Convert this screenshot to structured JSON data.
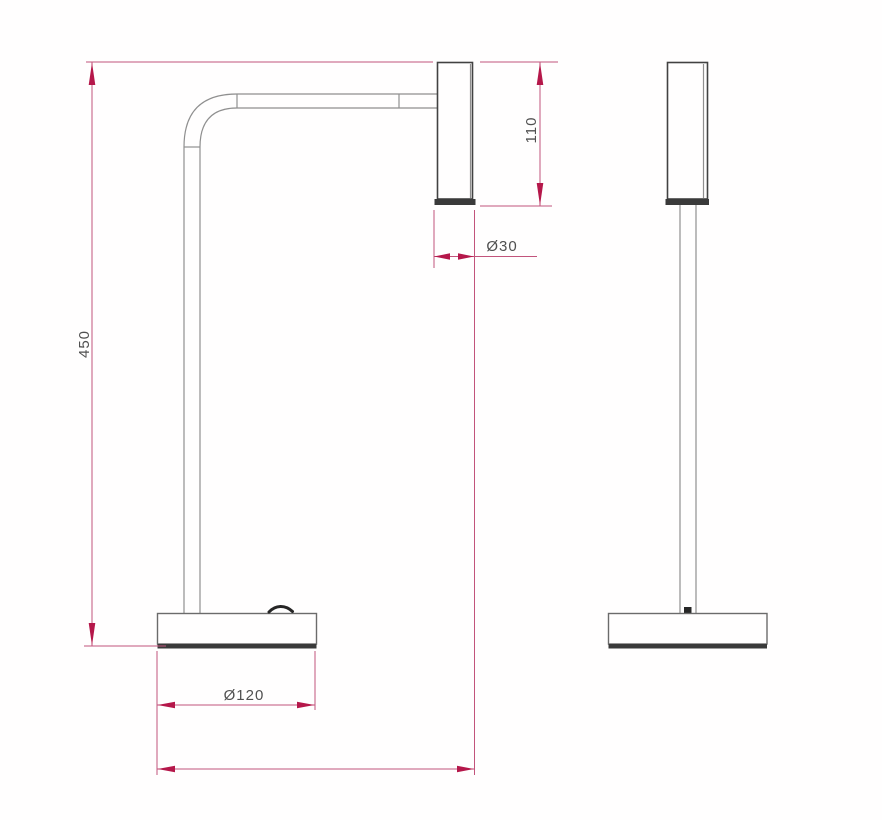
{
  "drawing": {
    "kind": "technical-dimension-drawing",
    "subject": "desk lamp, front and side orthographic views"
  },
  "dimensions": {
    "overall_height": "450",
    "head_height": "110",
    "head_diameter": "Ø30",
    "base_diameter": "Ø120",
    "overall_depth": "241"
  },
  "colors": {
    "background": "#ffffff",
    "dimension_line": "#c2547c",
    "dimension_arrow": "#b5174a",
    "dimension_text": "#505050",
    "outline_light": "#8f8f8f",
    "outline_medium": "#6b6b6b",
    "outline_dark": "#424242",
    "cap_fill": "#3a3a3a"
  }
}
